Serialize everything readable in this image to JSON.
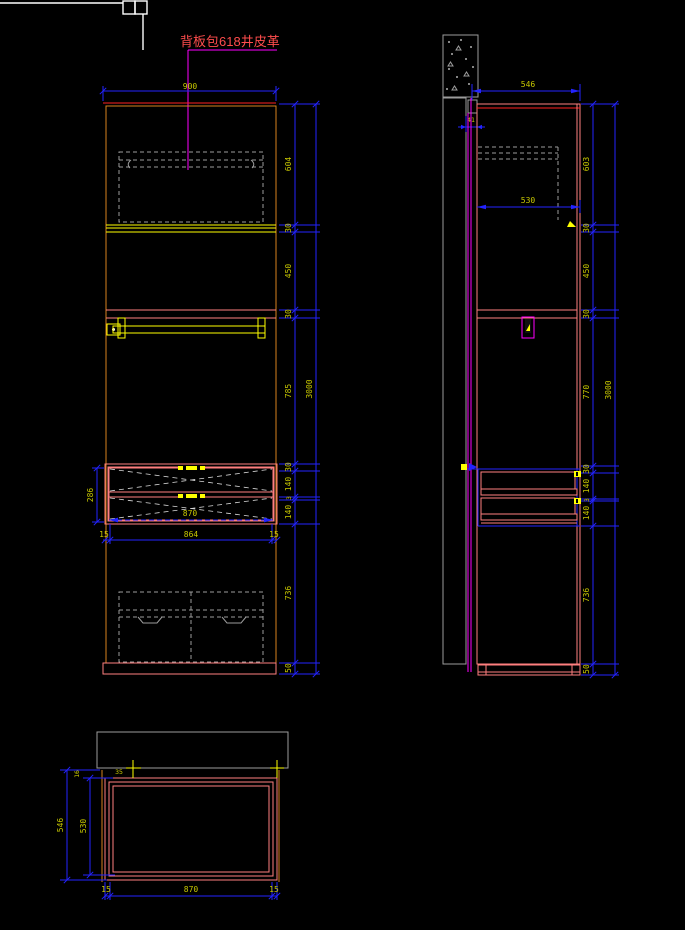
{
  "annotation": {
    "note": "背板包618井皮革"
  },
  "front_elevation": {
    "width": "900",
    "height_total": "3000",
    "segment_dims": [
      "604",
      "30",
      "450",
      "30",
      "785",
      "30",
      "140",
      "3",
      "140",
      "736",
      "50"
    ],
    "drawer_stack_height": "286",
    "drawer_clear_width": "870",
    "bottom_dims": [
      "15",
      "864",
      "15"
    ]
  },
  "side_elevation": {
    "depth": "546",
    "inner_depth": "530",
    "wall_offset": "41",
    "height_total": "3000",
    "segment_dims": [
      "603",
      "30",
      "450",
      "30",
      "770",
      "30",
      "140",
      "3",
      "140",
      "736",
      "50"
    ]
  },
  "plan_view": {
    "depth": "546",
    "inner_depth": "530",
    "back_gap": "16",
    "corner_detail": "35",
    "bottom_dims": [
      "15",
      "870",
      "15"
    ]
  },
  "colors": {
    "background": "#000000",
    "dimension_blue": "#2323ff",
    "dim_text_yellow": "#c8c800",
    "outline_orange": "#d9821e",
    "panel_pink": "#ff7f7f",
    "highlight_yellow": "#ffff00",
    "leader_magenta": "#ff00ff",
    "hidden_line_gray": "#9c9c9c",
    "annotation_red": "#ff4d4d"
  }
}
